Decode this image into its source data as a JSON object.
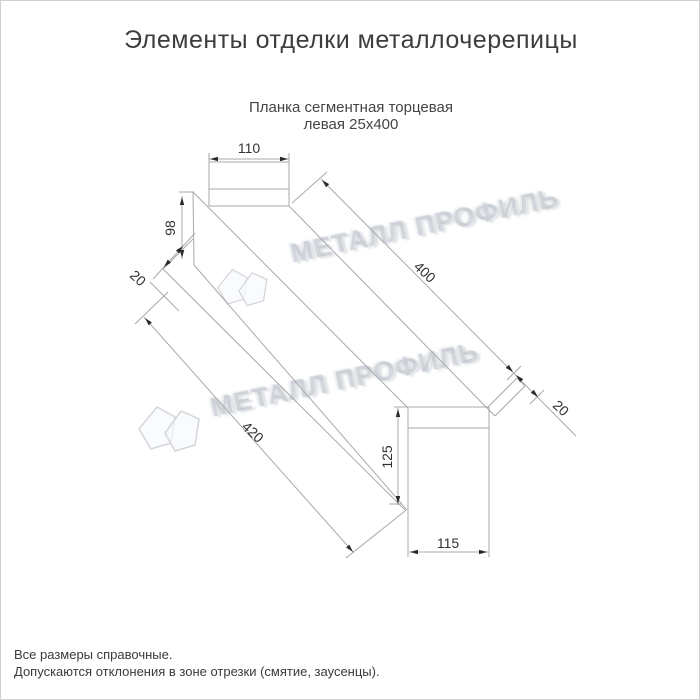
{
  "page": {
    "title": "Элементы отделки металлочерепицы"
  },
  "drawing": {
    "subtitle_line1": "Планка сегментная торцевая",
    "subtitle_line2": "левая 25х400",
    "dimensions": {
      "top_width": "110",
      "left_end_height": "98",
      "left_fold": "20",
      "top_edge_length": "400",
      "bottom_edge_length": "420",
      "right_fold": "20",
      "right_end_height": "125",
      "bottom_width": "115"
    },
    "watermark": {
      "text": "МЕТАЛЛ ПРОФИЛЬ",
      "logo": "metall-profil-logo",
      "color": "#d0d4da"
    }
  },
  "footer": {
    "note_line1": "Все размеры справочные.",
    "note_line2": "Допускаются отклонения в зоне отрезки (смятие, заусенцы)."
  },
  "colors": {
    "outline": "#a9a9a9",
    "dimension_text": "#333333",
    "title_text": "#3d3d3d"
  }
}
